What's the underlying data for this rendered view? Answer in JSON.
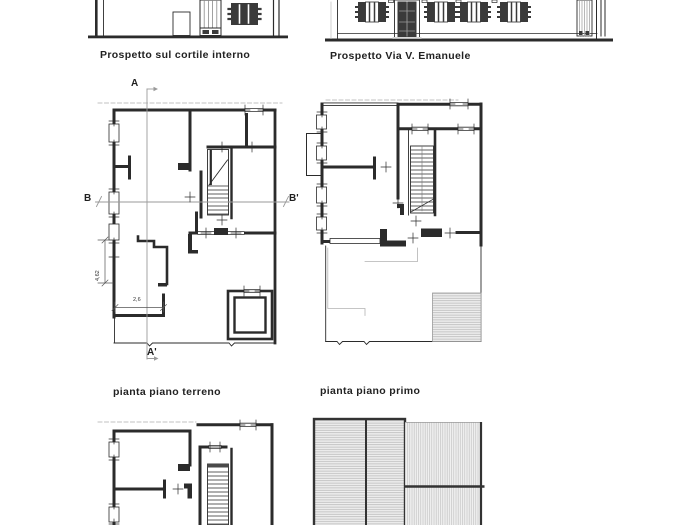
{
  "drawing": {
    "elevations": {
      "courtyard": {
        "caption": "Prospetto sul cortile interno"
      },
      "street": {
        "caption": "Prospetto Via V. Emanuele"
      }
    },
    "plans": {
      "ground": {
        "caption": "pianta piano terreno",
        "dim_vertical": "4,62",
        "dim_horizontal": "2,6"
      },
      "first": {
        "caption": "pianta piano primo"
      }
    },
    "sections": {
      "a_top": "A",
      "a_bottom": "A'",
      "b_left": "B",
      "b_right": "B'"
    },
    "colors": {
      "ink": "#2b2b2b",
      "section_line": "#9a9a9a",
      "hatch_line": "#b9b9b9",
      "background": "#ffffff"
    }
  }
}
